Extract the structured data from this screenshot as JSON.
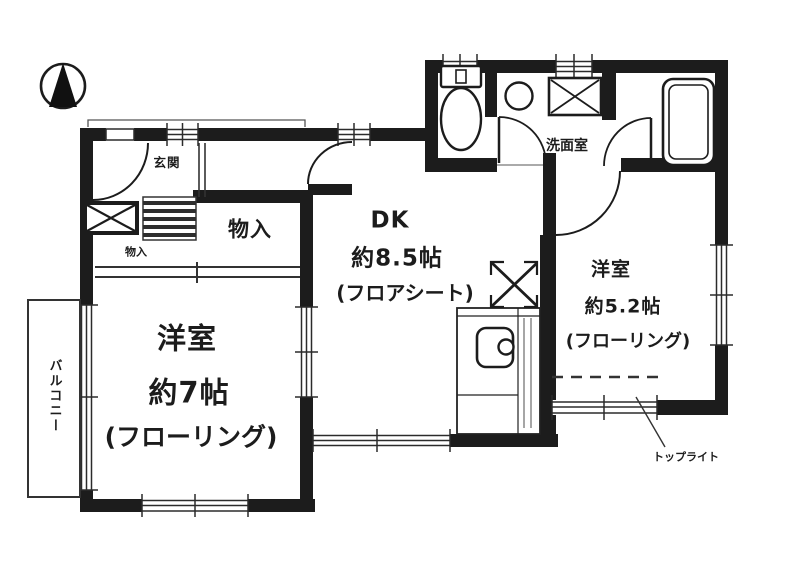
{
  "floor_plan": {
    "colors": {
      "wall": "#1c1c1c",
      "line": "#2b2b2b",
      "background": "#ffffff"
    },
    "compass": {
      "icon": "north-arrow"
    },
    "entrance": {
      "label": "玄関"
    },
    "hall_storage": {
      "label": "物入"
    },
    "storage": {
      "label": "物入"
    },
    "dk": {
      "name": "DK",
      "size": "約8.5帖",
      "floor": "(フロアシート)"
    },
    "washroom": {
      "label": "洗面室"
    },
    "western_room_large": {
      "name": "洋室",
      "size": "約7帖",
      "floor": "(フローリング)"
    },
    "western_room_small": {
      "name": "洋室",
      "size": "約5.2帖",
      "floor": "(フローリング)"
    },
    "balcony": {
      "label": "バルコニー"
    },
    "skylight": {
      "label": "トップライト"
    },
    "fixtures": [
      "toilet",
      "washbasin",
      "washing-machine-space",
      "bathtub",
      "kitchen-sink",
      "refrigerator-space",
      "meter-box",
      "entrance-step"
    ]
  }
}
